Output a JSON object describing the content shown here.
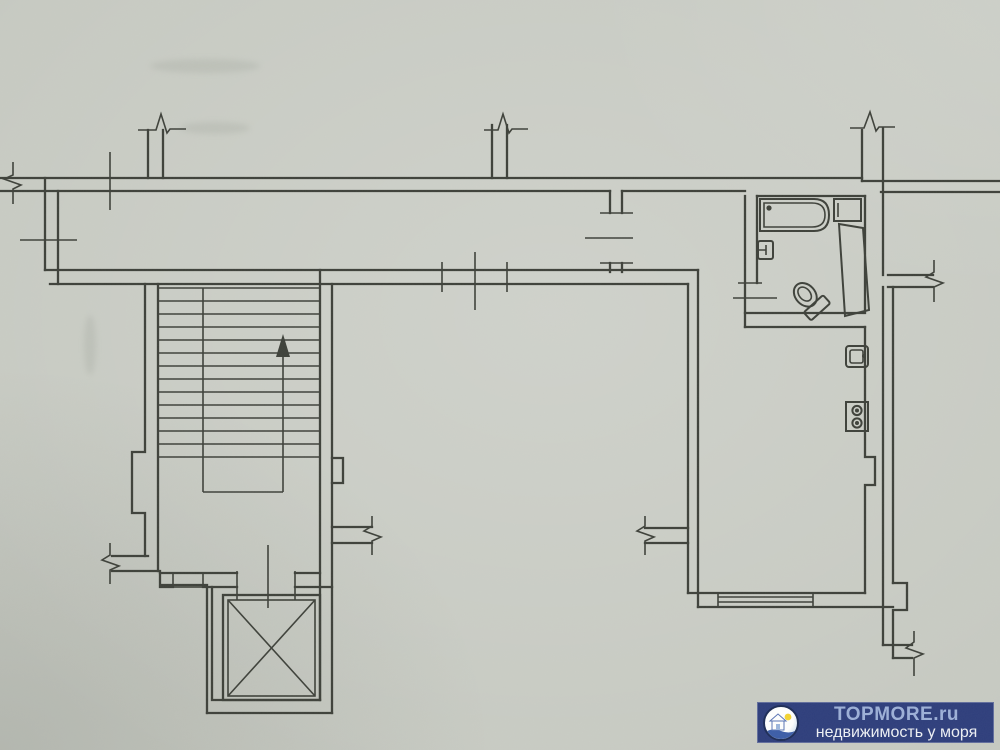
{
  "document": {
    "type": "apartment floor plan scan"
  },
  "palette": {
    "paper": "#c7cac2",
    "ink": "#3e413a",
    "watermark_bg": "#2e3e7c",
    "watermark_brand_color": "#9db0d8",
    "watermark_tagline_color": "#eef1f5",
    "badge_sun": "#f4d431",
    "badge_water": "#3c5da8"
  },
  "watermark": {
    "brand": "TOPMORE.ru",
    "tagline": "недвижимость у моря"
  },
  "plan": {
    "features": [
      {
        "id": "corridor",
        "type": "hallway"
      },
      {
        "id": "staircase",
        "type": "stairs",
        "flights": 2,
        "direction_arrow": "up"
      },
      {
        "id": "elevator",
        "type": "elevator-shaft",
        "symbol": "box-with-x"
      },
      {
        "id": "elevator-lobby",
        "type": "lobby"
      },
      {
        "id": "living-room",
        "type": "room",
        "south_wall": "open-with-break-marks"
      },
      {
        "id": "entrance-hall",
        "type": "vestibule",
        "door": "west-wall"
      },
      {
        "id": "bathroom",
        "type": "bathroom",
        "fixtures": [
          "bathtub",
          "wash-basin",
          "toilet",
          "door-leaf"
        ]
      },
      {
        "id": "kitchen",
        "type": "kitchen",
        "fixtures": [
          "kitchen-sink",
          "stove-two-burners"
        ],
        "window": "south-wall"
      },
      {
        "id": "wall-break-marks",
        "count": 9
      }
    ]
  }
}
